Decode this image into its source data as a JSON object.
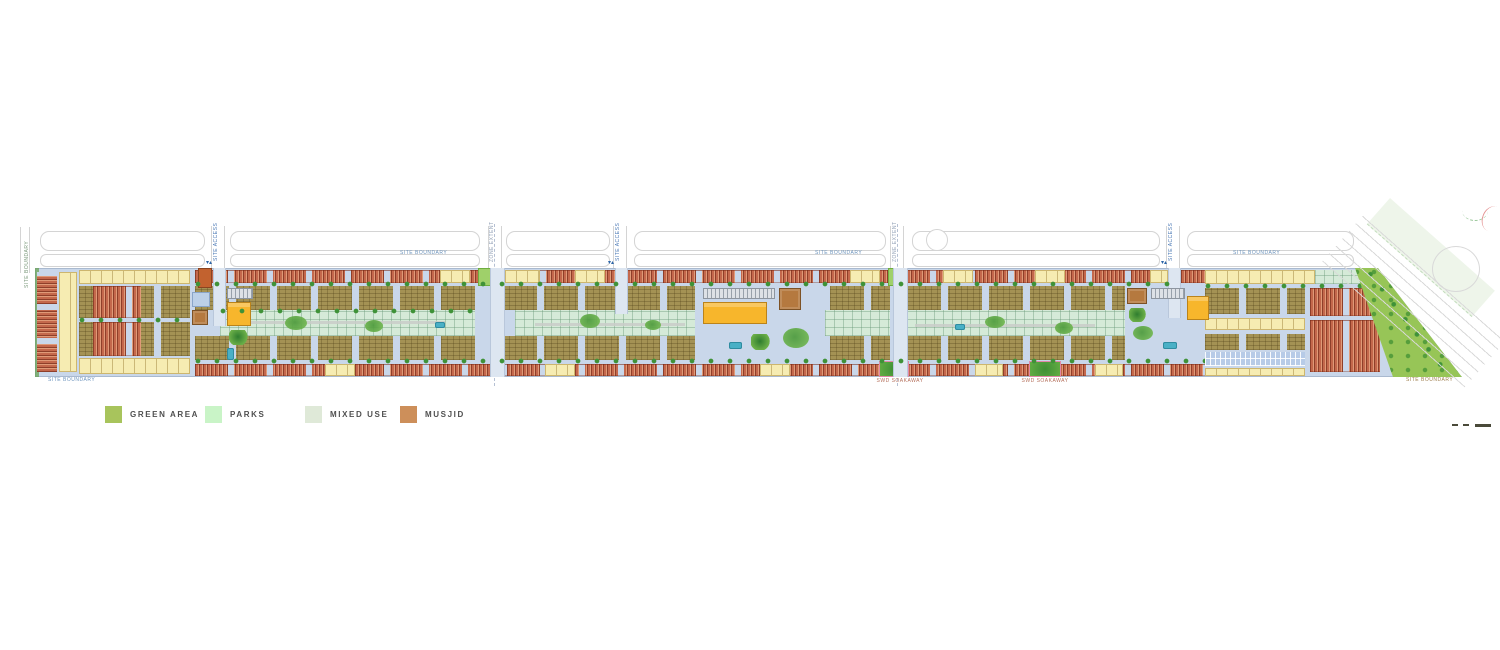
{
  "legend": {
    "items": [
      {
        "label": "GREEN AREA",
        "color": "#a8c45c"
      },
      {
        "label": "PARKS",
        "color": "#c9f4c7"
      },
      {
        "label": "MIXED USE",
        "color": "#dfe9d8"
      },
      {
        "label": "MUSJID",
        "color": "#cd8f5a"
      }
    ]
  },
  "labels": {
    "site_boundary": "SITE BOUNDARY",
    "site_access": "SITE ACCESS",
    "zone_extent": "ZONE EXTENT",
    "swd_soakaway": "SWD SOAKAWAY"
  },
  "map": {
    "colors": {
      "internal_road": "#c9d7ea",
      "rowhouse": "#bf6247",
      "apartment_block": "#a49254",
      "residential_plot": "#f6ecb2",
      "mixed_use": "#d5ead8",
      "park": "#9fd06a",
      "green_area": "#97c557",
      "musjid": "#b5793f",
      "school": "#f7b62c",
      "pool": "#49b0c6",
      "tree": "#3f9238"
    }
  }
}
